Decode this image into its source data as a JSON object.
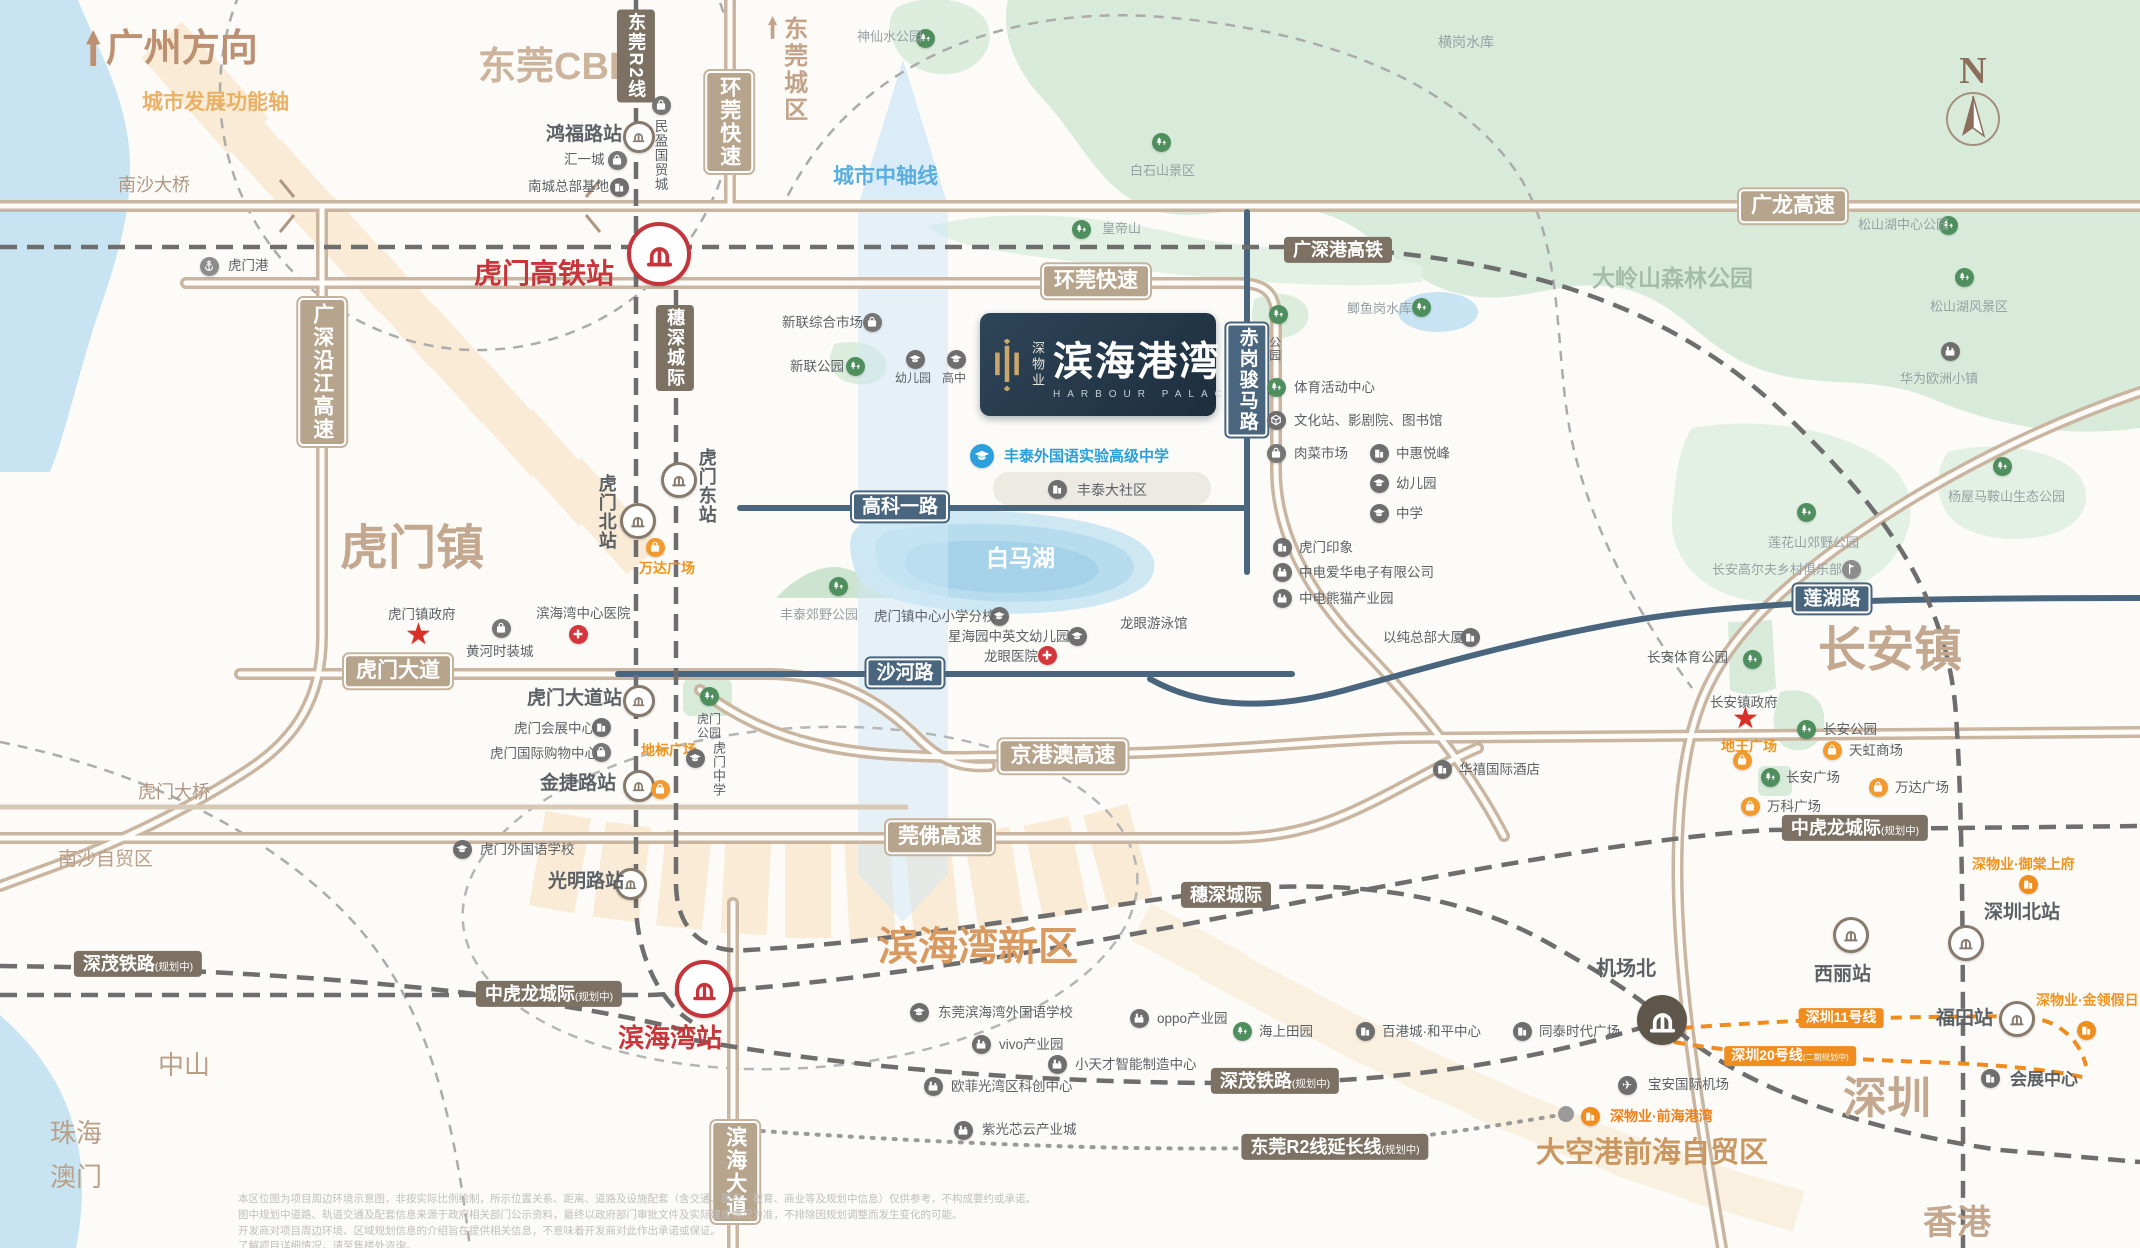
{
  "meta": {
    "width": 2140,
    "height": 1248
  },
  "compass": {
    "label": "N"
  },
  "logo_card": {
    "brand_vertical": "深物业",
    "name": "滨海港湾",
    "name_en": "HARBOUR PALACE"
  },
  "area_labels": [
    {
      "label": "广州方向",
      "x": 86,
      "y": 30,
      "fs": 38,
      "color": "#bd9071",
      "b": 1,
      "arrow": 1
    },
    {
      "label": "城市发展功能轴",
      "x": 142,
      "y": 92,
      "fs": 21,
      "color": "#eab166",
      "b": 1
    },
    {
      "label": "东莞CBD",
      "x": 478,
      "y": 48,
      "fs": 38,
      "color": "#ccb39c",
      "b": 1
    },
    {
      "label": "东莞城区",
      "x": 768,
      "y": 16,
      "fs": 24,
      "color": "#c2a389",
      "b": 1,
      "vert": 1,
      "arrow": 1
    },
    {
      "label": "虎门镇",
      "x": 340,
      "y": 524,
      "fs": 48,
      "color": "#c3a78f",
      "b": 1
    },
    {
      "label": "长安镇",
      "x": 1818,
      "y": 626,
      "fs": 48,
      "color": "#c3a78f",
      "b": 1
    },
    {
      "label": "滨海湾新区",
      "x": 878,
      "y": 926,
      "fs": 40,
      "color": "#d89a60",
      "b": 1
    },
    {
      "label": "大空港前海自贸区",
      "x": 1536,
      "y": 1138,
      "fs": 29,
      "color": "#c9975f",
      "b": 1
    },
    {
      "label": "深圳",
      "x": 1843,
      "y": 1076,
      "fs": 44,
      "color": "#c3a78f",
      "b": 1
    },
    {
      "label": "香港",
      "x": 1923,
      "y": 1206,
      "fs": 34,
      "color": "#c3a78f",
      "b": 1
    },
    {
      "label": "中山",
      "x": 158,
      "y": 1052,
      "fs": 26,
      "color": "#b99f88"
    },
    {
      "label": "珠海",
      "x": 50,
      "y": 1120,
      "fs": 26,
      "color": "#b99f88"
    },
    {
      "label": "澳门",
      "x": 50,
      "y": 1164,
      "fs": 26,
      "color": "#b99f88"
    },
    {
      "label": "南沙自贸区",
      "x": 58,
      "y": 850,
      "fs": 19,
      "color": "#b99f88"
    },
    {
      "label": "虎门大桥",
      "x": 138,
      "y": 783,
      "fs": 18,
      "color": "#b09682"
    },
    {
      "label": "南沙大桥",
      "x": 118,
      "y": 176,
      "fs": 18,
      "color": "#b09682"
    },
    {
      "label": "大岭山森林公园",
      "x": 1592,
      "y": 266,
      "fs": 23,
      "color": "#a4bda9",
      "b": 1
    },
    {
      "label": "白马湖",
      "x": 986,
      "y": 546,
      "fs": 23,
      "color": "#ffffff",
      "b": 1
    },
    {
      "label": "城市中轴线",
      "x": 833,
      "y": 166,
      "fs": 21,
      "color": "#58aede",
      "b": 1
    }
  ],
  "line_labels": [
    {
      "label": "环莞快速",
      "x": 729,
      "y": 122,
      "style": "hwy",
      "vert": 1
    },
    {
      "label": "环莞快速",
      "x": 1096,
      "y": 281,
      "style": "hwy"
    },
    {
      "label": "广龙高速",
      "x": 1793,
      "y": 206,
      "style": "hwy"
    },
    {
      "label": "京港澳高速",
      "x": 1063,
      "y": 756,
      "style": "hwy"
    },
    {
      "label": "莞佛高速",
      "x": 940,
      "y": 837,
      "style": "hwy"
    },
    {
      "label": "虎门大道",
      "x": 398,
      "y": 671,
      "style": "hwy"
    },
    {
      "label": "广深沿江高速",
      "x": 322,
      "y": 372,
      "style": "hwy",
      "vert": 1
    },
    {
      "label": "滨海大道",
      "x": 735,
      "y": 1172,
      "style": "hwy",
      "vert": 1
    },
    {
      "label": "广深港高铁",
      "x": 1338,
      "y": 250,
      "style": "rail"
    },
    {
      "label": "穗深城际",
      "x": 675,
      "y": 348,
      "style": "rail",
      "vert": 1
    },
    {
      "label": "东莞R2线",
      "x": 636,
      "y": 56,
      "style": "rail",
      "vert": 1
    },
    {
      "label": "穗深城际",
      "x": 1226,
      "y": 895,
      "style": "rail"
    },
    {
      "label": "中虎龙城际",
      "suffix": "(规划中)",
      "x": 549,
      "y": 994,
      "style": "rail"
    },
    {
      "label": "中虎龙城际",
      "suffix": "(规划中)",
      "x": 1855,
      "y": 828,
      "style": "rail"
    },
    {
      "label": "深茂铁路",
      "suffix": "(规划中)",
      "x": 138,
      "y": 964,
      "style": "rail"
    },
    {
      "label": "深茂铁路",
      "suffix": "(规划中)",
      "x": 1275,
      "y": 1081,
      "style": "rail"
    },
    {
      "label": "东莞R2线延长线",
      "suffix": "(规划中)",
      "x": 1335,
      "y": 1147,
      "style": "rail"
    },
    {
      "label": "高科一路",
      "x": 900,
      "y": 507,
      "style": "city"
    },
    {
      "label": "沙河路",
      "x": 905,
      "y": 673,
      "style": "city"
    },
    {
      "label": "莲湖路",
      "x": 1832,
      "y": 599,
      "style": "city"
    },
    {
      "label": "赤岗骏马路",
      "x": 1247,
      "y": 380,
      "style": "city",
      "vert": 1
    },
    {
      "label": "深圳11号线",
      "x": 1841,
      "y": 1018,
      "style": "metro"
    },
    {
      "label": "深圳20号线",
      "suffix": "(二期规划中)",
      "x": 1790,
      "y": 1056,
      "style": "metro"
    }
  ],
  "pois": [
    {
      "label": "虎门港",
      "tx": 228,
      "ty": 258,
      "icon": "anchor",
      "ix": 209,
      "iy": 266
    },
    {
      "label": "鸿福路站",
      "tx": 546,
      "ty": 124,
      "fs": 19,
      "b": 1,
      "icon": "metro",
      "ix": 636,
      "iy": 134
    },
    {
      "label": "民盈国贸城",
      "tx": 652,
      "ty": 119,
      "vert": 1,
      "icon": "bag",
      "ix": 661,
      "iy": 105
    },
    {
      "label": "汇一城",
      "tx": 564,
      "ty": 152,
      "icon": "bag",
      "ix": 617,
      "iy": 160
    },
    {
      "label": "南城总部基地",
      "tx": 528,
      "ty": 179,
      "icon": "bld",
      "ix": 619,
      "iy": 187
    },
    {
      "label": "虎门东站",
      "tx": 696,
      "ty": 448,
      "vert": 1,
      "fs": 18,
      "b": 1,
      "icon": "metro",
      "ix": 676,
      "iy": 477,
      "isz": 30
    },
    {
      "label": "虎门北站",
      "tx": 596,
      "ty": 474,
      "vert": 1,
      "fs": 18,
      "b": 1,
      "icon": "metro",
      "ix": 635,
      "iy": 518,
      "isz": 30
    },
    {
      "label": "万达广场",
      "tx": 638,
      "ty": 560,
      "w": 58,
      "style": "orange",
      "icon": "bagO",
      "ix": 655,
      "iy": 547
    },
    {
      "label": "虎门镇政府",
      "tx": 388,
      "ty": 607,
      "icon": "star",
      "ix": 420,
      "iy": 636
    },
    {
      "label": "黄河时装城",
      "tx": 466,
      "ty": 644,
      "icon": "bag",
      "ix": 501,
      "iy": 628
    },
    {
      "label": "滨海湾中心医院",
      "tx": 536,
      "ty": 606,
      "icon": "cross",
      "ix": 578,
      "iy": 634
    },
    {
      "label": "虎门大道站",
      "tx": 527,
      "ty": 688,
      "fs": 19,
      "b": 1,
      "icon": "metro",
      "ix": 636,
      "iy": 698
    },
    {
      "label": "虎门会展中心",
      "tx": 514,
      "ty": 721,
      "icon": "bld",
      "ix": 601,
      "iy": 727
    },
    {
      "label": "虎门国际购物中心",
      "tx": 490,
      "ty": 746,
      "icon": "bag",
      "ix": 601,
      "iy": 752
    },
    {
      "label": "金捷路站",
      "tx": 540,
      "ty": 773,
      "fs": 19,
      "b": 1,
      "icon": "metro",
      "ix": 636,
      "iy": 783
    },
    {
      "label": "地标广场",
      "tx": 640,
      "ty": 742,
      "w": 58,
      "style": "orange",
      "icon": "bagO",
      "ix": 660,
      "iy": 789
    },
    {
      "label": "虎门公园",
      "tx": 692,
      "ty": 713,
      "w": 34,
      "fs": 12,
      "icon": "tree",
      "ix": 709,
      "iy": 696
    },
    {
      "label": "虎门中学",
      "tx": 710,
      "ty": 741,
      "vert": 1,
      "fs": 13,
      "icon": "cap",
      "ix": 695,
      "iy": 758
    },
    {
      "label": "虎门外国语学校",
      "tx": 480,
      "ty": 842,
      "icon": "cap",
      "ix": 462,
      "iy": 849
    },
    {
      "label": "光明路站",
      "tx": 548,
      "ty": 871,
      "fs": 19,
      "b": 1,
      "icon": "metro",
      "ix": 628,
      "iy": 881
    },
    {
      "label": "新联综合市场",
      "tx": 782,
      "ty": 315,
      "icon": "bag",
      "ix": 872,
      "iy": 322
    },
    {
      "label": "新联公园",
      "tx": 790,
      "ty": 359,
      "icon": "tree",
      "ix": 855,
      "iy": 366
    },
    {
      "label": "幼儿园",
      "tx": 895,
      "ty": 372,
      "fs": 12,
      "icon": "cap",
      "ix": 915,
      "iy": 359
    },
    {
      "label": "高中",
      "tx": 942,
      "ty": 372,
      "fs": 12,
      "icon": "cap",
      "ix": 956,
      "iy": 359
    },
    {
      "label": "丰泰外国语实验高级中学",
      "tx": 1004,
      "ty": 448,
      "style": "blue",
      "fs": 15,
      "icon": "capB",
      "ix": 982,
      "iy": 456,
      "isz": 24
    },
    {
      "label": "丰泰大社区",
      "tx": 1077,
      "ty": 482,
      "fs": 14,
      "icon": "bld",
      "ix": 1057,
      "iy": 489
    },
    {
      "label": "虎门镇中心小学分校",
      "tx": 874,
      "ty": 609,
      "icon": "cap",
      "ix": 999,
      "iy": 616
    },
    {
      "label": "星海园中英文幼儿园",
      "tx": 948,
      "ty": 629,
      "icon": "cap",
      "ix": 1077,
      "iy": 636
    },
    {
      "label": "龙眼医院",
      "tx": 984,
      "ty": 649,
      "icon": "cross",
      "ix": 1047,
      "iy": 655
    },
    {
      "label": "龙眼游泳馆",
      "tx": 1120,
      "ty": 616
    },
    {
      "label": "公园",
      "tx": 1267,
      "ty": 336,
      "vert": 1,
      "fs": 12,
      "icon": "tree",
      "ix": 1278,
      "iy": 314
    },
    {
      "label": "体育活动中心",
      "tx": 1294,
      "ty": 380,
      "icon": "tree",
      "ix": 1276,
      "iy": 387
    },
    {
      "label": "文化站、影剧院、图书馆",
      "tx": 1294,
      "ty": 413,
      "icon": "cube",
      "ix": 1276,
      "iy": 420
    },
    {
      "label": "肉菜市场",
      "tx": 1294,
      "ty": 446,
      "icon": "bag",
      "ix": 1276,
      "iy": 453
    },
    {
      "label": "中惠悦峰",
      "tx": 1396,
      "ty": 446,
      "icon": "bld",
      "ix": 1379,
      "iy": 453
    },
    {
      "label": "幼儿园",
      "tx": 1396,
      "ty": 476,
      "icon": "cap",
      "ix": 1379,
      "iy": 483
    },
    {
      "label": "中学",
      "tx": 1396,
      "ty": 506,
      "icon": "cap",
      "ix": 1379,
      "iy": 513
    },
    {
      "label": "虎门印象",
      "tx": 1299,
      "ty": 540,
      "icon": "bld",
      "ix": 1282,
      "iy": 547
    },
    {
      "label": "中电爱华电子有限公司",
      "tx": 1299,
      "ty": 565,
      "icon": "fac",
      "ix": 1282,
      "iy": 572
    },
    {
      "label": "中电熊猫产业园",
      "tx": 1299,
      "ty": 591,
      "icon": "fac",
      "ix": 1282,
      "iy": 598
    },
    {
      "label": "以纯总部大厦",
      "tx": 1383,
      "ty": 630,
      "icon": "bld",
      "ix": 1470,
      "iy": 637
    },
    {
      "label": "华禧国际酒店",
      "tx": 1459,
      "ty": 762,
      "icon": "bld",
      "ix": 1442,
      "iy": 769
    },
    {
      "label": "长安体育公园",
      "tx": 1647,
      "ty": 650,
      "icon": "tree",
      "ix": 1752,
      "iy": 659
    },
    {
      "label": "长安镇政府",
      "tx": 1710,
      "ty": 695,
      "icon": "star",
      "ix": 1747,
      "iy": 720
    },
    {
      "label": "地王广场",
      "tx": 1721,
      "ty": 738,
      "style": "orange",
      "icon": "bagO",
      "ix": 1742,
      "iy": 760
    },
    {
      "label": "长安公园",
      "tx": 1823,
      "ty": 722,
      "icon": "tree",
      "ix": 1806,
      "iy": 729
    },
    {
      "label": "天虹商场",
      "tx": 1849,
      "ty": 743,
      "icon": "bagO",
      "ix": 1832,
      "iy": 750
    },
    {
      "label": "长安广场",
      "tx": 1786,
      "ty": 770,
      "icon": "tree",
      "ix": 1770,
      "iy": 777
    },
    {
      "label": "万达广场",
      "tx": 1895,
      "ty": 780,
      "icon": "bagO",
      "ix": 1878,
      "iy": 787
    },
    {
      "label": "万科广场",
      "tx": 1767,
      "ty": 799,
      "icon": "bagO",
      "ix": 1750,
      "iy": 806
    },
    {
      "label": "深物业·御棠上府",
      "tx": 1972,
      "ty": 856,
      "style": "orange",
      "icon": "bldO",
      "ix": 2028,
      "iy": 884
    },
    {
      "label": "深圳北站",
      "tx": 1984,
      "ty": 902,
      "fs": 19,
      "b": 1,
      "icon": "metro",
      "ix": 1963,
      "iy": 940,
      "isz": 30
    },
    {
      "label": "西丽站",
      "tx": 1814,
      "ty": 964,
      "fs": 19,
      "b": 1,
      "icon": "metro",
      "ix": 1848,
      "iy": 932,
      "isz": 30
    },
    {
      "label": "福田站",
      "tx": 1936,
      "ty": 1008,
      "fs": 19,
      "b": 1,
      "icon": "metro",
      "ix": 2014,
      "iy": 1016,
      "isz": 30
    },
    {
      "label": "深物业·金领假日",
      "tx": 2036,
      "ty": 992,
      "style": "orange",
      "icon": "bldO",
      "ix": 2086,
      "iy": 1030
    },
    {
      "label": "会展中心",
      "tx": 2010,
      "ty": 1070,
      "fs": 17,
      "b": 1,
      "icon": "bld",
      "ix": 1990,
      "iy": 1078
    },
    {
      "label": "机场北",
      "tx": 1596,
      "ty": 958,
      "fs": 20,
      "b": 1,
      "icon": "hsrD",
      "ix": 1662,
      "iy": 1020,
      "isz": 50
    },
    {
      "label": "宝安国际机场",
      "tx": 1648,
      "ty": 1077,
      "icon": "plane",
      "ix": 1627,
      "iy": 1085
    },
    {
      "label": "深物业·前海港湾",
      "tx": 1610,
      "ty": 1108,
      "style": "deepO",
      "icon": "bldO",
      "ix": 1590,
      "iy": 1116
    },
    {
      "label": "紫光芯云产业城",
      "tx": 982,
      "ty": 1122,
      "icon": "fac",
      "ix": 963,
      "iy": 1130
    },
    {
      "label": "东莞滨海湾外国语学校",
      "tx": 938,
      "ty": 1005,
      "icon": "cap",
      "ix": 919,
      "iy": 1012
    },
    {
      "label": "oppo产业园",
      "tx": 1157,
      "ty": 1011,
      "icon": "fac",
      "ix": 1139,
      "iy": 1018
    },
    {
      "label": "vivo产业园",
      "tx": 999,
      "ty": 1037,
      "icon": "fac",
      "ix": 981,
      "iy": 1044
    },
    {
      "label": "小天才智能制造中心",
      "tx": 1075,
      "ty": 1057,
      "icon": "fac",
      "ix": 1057,
      "iy": 1064
    },
    {
      "label": "欧菲光湾区科创中心",
      "tx": 951,
      "ty": 1079,
      "icon": "fac",
      "ix": 933,
      "iy": 1086
    },
    {
      "label": "海上田园",
      "tx": 1259,
      "ty": 1024,
      "icon": "tree",
      "ix": 1242,
      "iy": 1031
    },
    {
      "label": "百港城·和平中心",
      "tx": 1382,
      "ty": 1024,
      "icon": "bld",
      "ix": 1365,
      "iy": 1031
    },
    {
      "label": "同泰时代广场",
      "tx": 1539,
      "ty": 1024,
      "icon": "bld",
      "ix": 1522,
      "iy": 1031
    },
    {
      "label": "虎门高铁站",
      "tx": 474,
      "ty": 258,
      "style": "red",
      "fs": 28,
      "icon": "hsrR",
      "ix": 655,
      "iy": 250,
      "isz": 56
    },
    {
      "label": "滨海湾站",
      "tx": 618,
      "ty": 1024,
      "style": "red",
      "fs": 26,
      "icon": "hsrR",
      "ix": 700,
      "iy": 985,
      "isz": 50
    },
    {
      "label": "神仙水公园",
      "tx": 857,
      "ty": 30,
      "style": "faint",
      "icon": "tree",
      "ix": 925,
      "iy": 38
    },
    {
      "label": "白石山景区",
      "tx": 1130,
      "ty": 164,
      "style": "faint",
      "icon": "tree",
      "ix": 1161,
      "iy": 142
    },
    {
      "label": "皇帝山",
      "tx": 1102,
      "ty": 222,
      "style": "faint",
      "icon": "tree",
      "ix": 1081,
      "iy": 229
    },
    {
      "label": "横岗水库",
      "tx": 1438,
      "ty": 34,
      "style": "faint",
      "fs": 14
    },
    {
      "label": "松山湖中心公园",
      "tx": 1858,
      "ty": 218,
      "style": "faint",
      "icon": "tree",
      "ix": 1948,
      "iy": 225
    },
    {
      "label": "松山湖风景区",
      "tx": 1930,
      "ty": 300,
      "style": "faint",
      "icon": "tree",
      "ix": 1964,
      "iy": 277
    },
    {
      "label": "华为欧洲小镇",
      "tx": 1900,
      "ty": 372,
      "style": "faint",
      "icon": "fac",
      "ix": 1950,
      "iy": 351
    },
    {
      "label": "莲花山郊野公园",
      "tx": 1768,
      "ty": 536,
      "style": "faint",
      "icon": "tree",
      "ix": 1806,
      "iy": 512
    },
    {
      "label": "长安高尔夫乡村俱乐部",
      "tx": 1712,
      "ty": 563,
      "style": "faint",
      "icon": "golf",
      "ix": 1851,
      "iy": 569
    },
    {
      "label": "杨屋马鞍山生态公园",
      "tx": 1948,
      "ty": 490,
      "style": "faint",
      "icon": "tree",
      "ix": 2002,
      "iy": 466
    },
    {
      "label": "鲫鱼岗水库",
      "tx": 1347,
      "ty": 302,
      "style": "faint",
      "icon": "tree",
      "ix": 1421,
      "iy": 307
    },
    {
      "label": "丰泰郊野公园",
      "tx": 780,
      "ty": 608,
      "style": "faint",
      "icon": "tree",
      "ix": 838,
      "iy": 586
    }
  ],
  "disclaimer": {
    "lines": [
      "本区位图为项目周边环境示意图，非按实际比例绘制，所示位置关系、距离、道路及设施配套（含交通、医疗、教育、商业等及规划中信息）仅供参考，不构成要约或承诺。",
      "图中规划中道路、轨道交通及配套信息来源于政府相关部门公示资料，最终以政府部门审批文件及实际建成情况为准，不排除因规划调整而发生变化的可能。",
      "开发商对项目周边环境、区域规划信息的介绍旨在提供相关信息，不意味着开发商对此作出承诺或保证。",
      "了解项目详细情况，请至售楼处咨询。"
    ]
  }
}
